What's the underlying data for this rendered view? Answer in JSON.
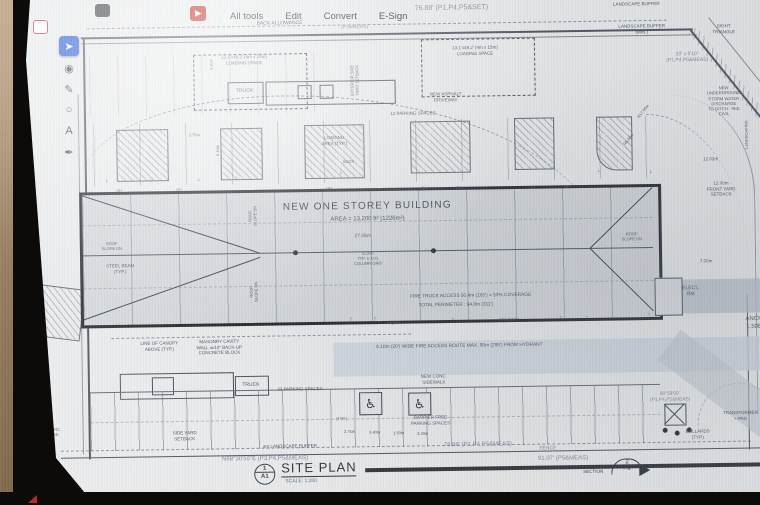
{
  "acrobat": {
    "menu": [
      "All tools",
      "Edit",
      "Convert",
      "E-Sign"
    ],
    "tools": [
      {
        "name": "select-tool",
        "glyph": "➤",
        "selected": true
      },
      {
        "name": "comment-tool",
        "glyph": "◉",
        "selected": false
      },
      {
        "name": "pencil-tool",
        "glyph": "✎",
        "selected": false
      },
      {
        "name": "shape-tool",
        "glyph": "○",
        "selected": false
      },
      {
        "name": "text-tool",
        "glyph": "A",
        "selected": false
      },
      {
        "name": "sign-tool",
        "glyph": "✒",
        "selected": false
      }
    ]
  },
  "plan": {
    "building": {
      "title": "NEW ONE STOREY BUILDING",
      "area": "AREA = 13,200 ft² (1226m²)"
    },
    "title_block": {
      "detail_num": "1",
      "detail_sheet": "A1",
      "title": "SITE PLAN",
      "scale": "SCALE: 1:200",
      "section_label": "SECTION",
      "section_num": "2",
      "section_sheet": "A1"
    },
    "icons": {
      "wheelchair": "♿"
    },
    "colors": {
      "paper": "#e9ebec",
      "ink": "#4d5664",
      "survey": "#838d9b",
      "accent_blue": "#2b5ed8",
      "adobe_red": "#c3271e"
    },
    "labels": [
      {
        "t": "BACK ALLOWANCE",
        "x": 283,
        "y": 22,
        "s": 5
      },
      {
        "t": "76.88' (P1,P4,P5&SET)",
        "x": 455,
        "y": 10,
        "s": 7,
        "c": "dim"
      },
      {
        "t": "(P5&MEAS)",
        "x": 358,
        "y": 27,
        "s": 5,
        "c": "dim"
      },
      {
        "t": "LANDSCAPE BUFFER",
        "x": 640,
        "y": 8,
        "s": 4.5
      },
      {
        "t": "LANDSCAPE BUFFER\n(MIN.)",
        "x": 645,
        "y": 33,
        "s": 4.5
      },
      {
        "t": "SIGHT\nTRIANGLE",
        "x": 727,
        "y": 34,
        "s": 4.5
      },
      {
        "t": "20' x 9'10\"\n(P1,P4,P5&MEAS)",
        "x": 690,
        "y": 62,
        "s": 5,
        "c": "dim"
      },
      {
        "t": "13.1'x49.2' (4m x 15m)\nLOADING SPACE",
        "x": 247,
        "y": 58,
        "s": 4.5
      },
      {
        "t": "13.1'x49.2' (4m x 15m)\nLOADING SPACE",
        "x": 478,
        "y": 52,
        "s": 4.5
      },
      {
        "t": "TRUCK",
        "x": 247,
        "y": 89,
        "s": 5
      },
      {
        "t": "NEW ASPHALT\nDRIVEWAY",
        "x": 448,
        "y": 98,
        "s": 4.5
      },
      {
        "t": "EXTERIOR SIDE\nYARD SETBACK",
        "x": 357,
        "y": 80,
        "s": 4,
        "r": -90
      },
      {
        "t": "4.30m",
        "x": 214,
        "y": 62,
        "s": 4,
        "r": -90
      },
      {
        "t": "6.10m",
        "x": 219,
        "y": 148,
        "s": 4,
        "r": -90
      },
      {
        "t": "2.75m",
        "x": 196,
        "y": 132,
        "s": 4
      },
      {
        "t": "12 PARKING SPACES",
        "x": 415,
        "y": 114,
        "s": 4.5
      },
      {
        "t": "LOADING\nAREA (TYP.)",
        "x": 336,
        "y": 140,
        "s": 4.5
      },
      {
        "t": "BACK",
        "x": 350,
        "y": 161,
        "s": 4
      },
      {
        "t": "OH",
        "x": 120,
        "y": 187,
        "s": 3.5
      },
      {
        "t": "OH",
        "x": 180,
        "y": 187,
        "s": 3.5
      },
      {
        "t": "OH",
        "x": 330,
        "y": 188,
        "s": 3.5
      },
      {
        "t": "OH",
        "x": 425,
        "y": 189,
        "s": 3.5
      },
      {
        "t": "OH",
        "x": 460,
        "y": 189,
        "s": 3.5
      },
      {
        "t": "OH",
        "x": 533,
        "y": 190,
        "s": 3.5
      },
      {
        "t": "OH",
        "x": 568,
        "y": 190,
        "s": 3.5
      },
      {
        "t": "↓",
        "x": 108,
        "y": 178,
        "s": 6
      },
      {
        "t": "↓",
        "x": 152,
        "y": 178,
        "s": 6
      },
      {
        "t": "↓",
        "x": 200,
        "y": 178,
        "s": 6
      },
      {
        "t": "↓",
        "x": 342,
        "y": 173,
        "s": 6
      },
      {
        "t": "↓",
        "x": 600,
        "y": 175,
        "s": 6
      },
      {
        "t": "↓",
        "x": 652,
        "y": 177,
        "s": 6
      },
      {
        "t": "ROOF\nSLOPE DN",
        "x": 253,
        "y": 214,
        "s": 4,
        "r": -90
      },
      {
        "t": "ROOF\nSLOPE DN",
        "x": 253,
        "y": 290,
        "s": 4,
        "r": -90
      },
      {
        "t": "ROOF\nSLOPE DN",
        "x": 112,
        "y": 242,
        "s": 4
      },
      {
        "t": "ROOF\nSLOPE DN",
        "x": 632,
        "y": 240,
        "s": 4
      },
      {
        "t": "STEEL BEAM\n(TYP.)",
        "x": 120,
        "y": 265,
        "s": 4.5
      },
      {
        "t": "27.06m",
        "x": 363,
        "y": 236,
        "s": 5
      },
      {
        "t": "6.10m\nTYP. U.N.O.\nCOLUMN GRID",
        "x": 368,
        "y": 258,
        "s": 4
      },
      {
        "t": "FIRE TRUCK ACCESS 50.4m (165') = 53% COVERAGE",
        "x": 470,
        "y": 298,
        "s": 4.8
      },
      {
        "t": "TOTAL PERIMETER : 94.8m (311')",
        "x": 455,
        "y": 307,
        "s": 4.8
      },
      {
        "t": "FRONT",
        "x": 392,
        "y": 323,
        "s": 4
      },
      {
        "t": "WALKWAY",
        "x": 508,
        "y": 321,
        "s": 4
      },
      {
        "t": "↑",
        "x": 350,
        "y": 320,
        "s": 6
      },
      {
        "t": "↑",
        "x": 374,
        "y": 320,
        "s": 6
      },
      {
        "t": "↑",
        "x": 452,
        "y": 322,
        "s": 6
      },
      {
        "t": "↑",
        "x": 560,
        "y": 322,
        "s": 6
      },
      {
        "t": "↑",
        "x": 586,
        "y": 322,
        "s": 6
      },
      {
        "t": "↑",
        "x": 648,
        "y": 320,
        "s": 6
      },
      {
        "t": "LINE OF CANOPY\nABOVE (TYP.)",
        "x": 158,
        "y": 343,
        "s": 4.5
      },
      {
        "t": "MASONRY CAVITY\nWALL w/10\" BACK-UP\nCONCRETE BLOCK",
        "x": 218,
        "y": 345,
        "s": 4.5
      },
      {
        "t": "TRUCK",
        "x": 249,
        "y": 383,
        "s": 5
      },
      {
        "t": "23 PARKING SPACES",
        "x": 298,
        "y": 388,
        "s": 4.5
      },
      {
        "t": "6.10m (20') WIDE FIRE ACCESS ROUTE MAX. 90m (295') FROM HYDRANT",
        "x": 458,
        "y": 348,
        "s": 4.8
      },
      {
        "t": "NEW CONC.\nSIDEWALK",
        "x": 432,
        "y": 380,
        "s": 4.5
      },
      {
        "t": "BARRIER FREE\nPARKING SPACES",
        "x": 428,
        "y": 421,
        "s": 4.5
      },
      {
        "t": "(TYP.)",
        "x": 339,
        "y": 418,
        "s": 4
      },
      {
        "t": "2.75m",
        "x": 347,
        "y": 431,
        "s": 4
      },
      {
        "t": "3.40m",
        "x": 372,
        "y": 432,
        "s": 4
      },
      {
        "t": "1.50m",
        "x": 396,
        "y": 433,
        "s": 4
      },
      {
        "t": "3.40m",
        "x": 420,
        "y": 434,
        "s": 4
      },
      {
        "t": "SIDE YARD\nSETBACK",
        "x": 182,
        "y": 433,
        "s": 4.5
      },
      {
        "t": "3m LANDSCAPE BUFFER",
        "x": 287,
        "y": 445,
        "s": 4.5
      },
      {
        "t": "CONC.\nPAD",
        "x": 52,
        "y": 427,
        "s": 4
      },
      {
        "t": "N68°30'50\"E  (P3,P4,P5&MEAS)",
        "x": 262,
        "y": 458,
        "s": 6,
        "c": "dim"
      },
      {
        "t": "78.88' (P1,P4,P5&MEAS)",
        "x": 475,
        "y": 447,
        "s": 6,
        "c": "dim"
      },
      {
        "t": "FENCE",
        "x": 545,
        "y": 451,
        "s": 5,
        "c": "dim"
      },
      {
        "t": "91.07' (P5&MEAS)",
        "x": 560,
        "y": 462,
        "s": 6,
        "c": "dim"
      },
      {
        "t": "88°59'00\"\n(P1,P4,P5&MEAS)",
        "x": 668,
        "y": 402,
        "s": 4.8,
        "c": "dim"
      },
      {
        "t": "BOLLARDS\n(TYP.)",
        "x": 695,
        "y": 439,
        "s": 4.5
      },
      {
        "t": "TRANSFORMER\n+ PAD",
        "x": 738,
        "y": 421,
        "s": 4.5
      },
      {
        "t": "ELEC'L\nRM",
        "x": 690,
        "y": 296,
        "s": 5
      },
      {
        "t": "ANCH\n1.50E",
        "x": 753,
        "y": 329,
        "s": 6
      },
      {
        "t": "7.00m",
        "x": 706,
        "y": 266,
        "s": 4.5
      },
      {
        "t": "12.02m",
        "x": 712,
        "y": 164,
        "s": 4.5
      },
      {
        "t": "12.00m\nFRONT YARD\nSETBACK",
        "x": 722,
        "y": 194,
        "s": 4.5
      },
      {
        "t": "NEW UNDERGROUND\nSTORM WATER DISCHARGE\nTO DITCH - SEE CIVIL",
        "x": 726,
        "y": 106,
        "s": 4.2
      },
      {
        "t": "LANDSCAPING",
        "x": 748,
        "y": 140,
        "s": 4,
        "r": -90
      },
      {
        "t": "R17.00m",
        "x": 645,
        "y": 115,
        "s": 4,
        "r": -50
      },
      {
        "t": "R5.00m",
        "x": 630,
        "y": 143,
        "s": 4,
        "r": -50
      }
    ]
  }
}
